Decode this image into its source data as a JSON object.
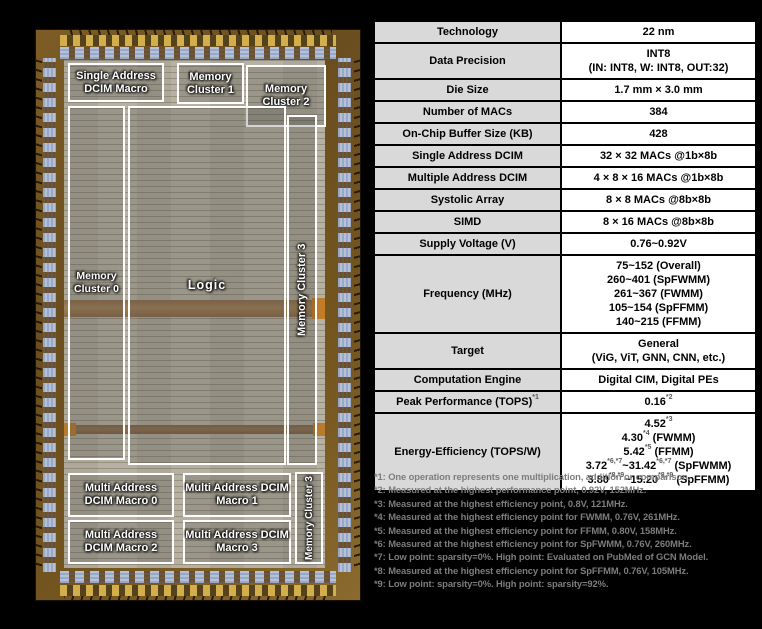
{
  "die": {
    "boxes": {
      "single_address": {
        "lines": [
          "Single Address",
          "DCIM Macro"
        ]
      },
      "memory_cluster_1": {
        "lines": [
          "Memory",
          "Cluster 1"
        ]
      },
      "memory_cluster_2": {
        "lines": [
          "Memory",
          "Cluster 2"
        ]
      },
      "memory_cluster_0": {
        "lines": [
          "Memory",
          "Cluster 0"
        ]
      },
      "logic": {
        "lines": [
          "Logic"
        ]
      },
      "memory_cluster_3_tall": {
        "lines": [
          "Memory Cluster 3"
        ]
      },
      "multi_address_0": {
        "lines": [
          "Multi Address",
          "DCIM Macro 0"
        ]
      },
      "multi_address_1": {
        "lines": [
          "Multi Address DCIM",
          "Macro 1"
        ]
      },
      "multi_address_2": {
        "lines": [
          "Multi Address",
          "DCIM Macro 2"
        ]
      },
      "multi_address_3": {
        "lines": [
          "Multi Address DCIM",
          "Macro 3"
        ]
      },
      "memory_cluster_3_bottom": {
        "lines": [
          "Memory Cluster 3"
        ]
      }
    }
  },
  "table": {
    "rows": [
      {
        "label": [
          {
            "t": "Technology"
          }
        ],
        "value": [
          [
            {
              "t": "22 nm"
            }
          ]
        ]
      },
      {
        "label": [
          {
            "t": "Data Precision"
          }
        ],
        "value": [
          [
            {
              "t": "INT8"
            }
          ],
          [
            {
              "t": "(IN: INT8, W: INT8, OUT:32)"
            }
          ]
        ]
      },
      {
        "label": [
          {
            "t": "Die Size"
          }
        ],
        "value": [
          [
            {
              "t": "1.7 mm × 3.0 mm"
            }
          ]
        ]
      },
      {
        "label": [
          {
            "t": "Number of MACs"
          }
        ],
        "value": [
          [
            {
              "t": "384"
            }
          ]
        ]
      },
      {
        "label": [
          {
            "t": "On-Chip Buffer Size (KB)"
          }
        ],
        "value": [
          [
            {
              "t": "428"
            }
          ]
        ]
      },
      {
        "label": [
          {
            "t": "Single Address DCIM"
          }
        ],
        "value": [
          [
            {
              "t": "32 × 32 MACs @1b×8b"
            }
          ]
        ]
      },
      {
        "label": [
          {
            "t": "Multiple Address DCIM"
          }
        ],
        "value": [
          [
            {
              "t": "4 × 8 × 16 MACs @1b×8b"
            }
          ]
        ]
      },
      {
        "label": [
          {
            "t": "Systolic Array"
          }
        ],
        "value": [
          [
            {
              "t": "8 × 8 MACs @8b×8b"
            }
          ]
        ]
      },
      {
        "label": [
          {
            "t": "SIMD"
          }
        ],
        "value": [
          [
            {
              "t": "8 × 16 MACs @8b×8b"
            }
          ]
        ]
      },
      {
        "label": [
          {
            "t": "Supply Voltage (V)"
          }
        ],
        "value": [
          [
            {
              "t": "0.76~0.92V"
            }
          ]
        ]
      },
      {
        "label": [
          {
            "t": "Frequency (MHz)"
          }
        ],
        "value": [
          [
            {
              "t": "75~152 (Overall)"
            }
          ],
          [
            {
              "t": "260~401 (SpFWMM)"
            }
          ],
          [
            {
              "t": "261~367 (FWMM)"
            }
          ],
          [
            {
              "t": "105~154 (SpFFMM)"
            }
          ],
          [
            {
              "t": "140~215 (FFMM)"
            }
          ]
        ]
      },
      {
        "label": [
          {
            "t": "Target"
          }
        ],
        "value": [
          [
            {
              "t": "General"
            }
          ],
          [
            {
              "t": "(ViG, ViT, GNN, CNN, etc.)"
            }
          ]
        ]
      },
      {
        "label": [
          {
            "t": "Computation Engine"
          }
        ],
        "value": [
          [
            {
              "t": "Digital CIM, Digital PEs"
            }
          ]
        ]
      },
      {
        "label": [
          {
            "t": "Peak Performance (TOPS)"
          },
          {
            "s": "*1"
          }
        ],
        "value": [
          [
            {
              "t": "0.16"
            },
            {
              "s": "*2"
            }
          ]
        ]
      },
      {
        "label": [
          {
            "t": "Energy-Efficiency (TOPS/W)"
          }
        ],
        "value": [
          [
            {
              "t": "4.52"
            },
            {
              "s": "*3"
            }
          ],
          [
            {
              "t": "4.30"
            },
            {
              "s": "*4"
            },
            {
              "t": " (FWMM)"
            }
          ],
          [
            {
              "t": "5.42"
            },
            {
              "s": "*5"
            },
            {
              "t": " (FFMM)"
            }
          ],
          [
            {
              "t": "3.72"
            },
            {
              "s": "*6,*7"
            },
            {
              "t": "~31.42"
            },
            {
              "s": "*6,*7"
            },
            {
              "t": " (SpFWMM)"
            }
          ],
          [
            {
              "t": "3.80"
            },
            {
              "s": "*8,*9"
            },
            {
              "t": "~15.20"
            },
            {
              "s": "*8,*9"
            },
            {
              "t": " (SpFFMM)"
            }
          ]
        ]
      }
    ]
  },
  "footnotes": [
    "*1: One operation represents one multiplication, addition or comparison.",
    "*2: Measured at the highest performance point, 0.92V, 152MHz.",
    "*3: Measured at the highest efficiency point, 0.8V, 121MHz.",
    "*4: Measured at the highest efficiency point for FWMM, 0.76V, 261MHz.",
    "*5: Measured at the highest efficiency point for FFMM, 0.80V, 158MHz.",
    "*6: Measured at the highest efficiency point for SpFWMM, 0.76V, 260MHz.",
    "*7: Low point: sparsity=0%. High point: Evaluated on PubMed of GCN Model.",
    "*8: Measured at the highest efficiency point for SpFFMM, 0.76V, 105MHz.",
    "*9: Low point: sparsity=0%. High point: sparsity=92%."
  ]
}
